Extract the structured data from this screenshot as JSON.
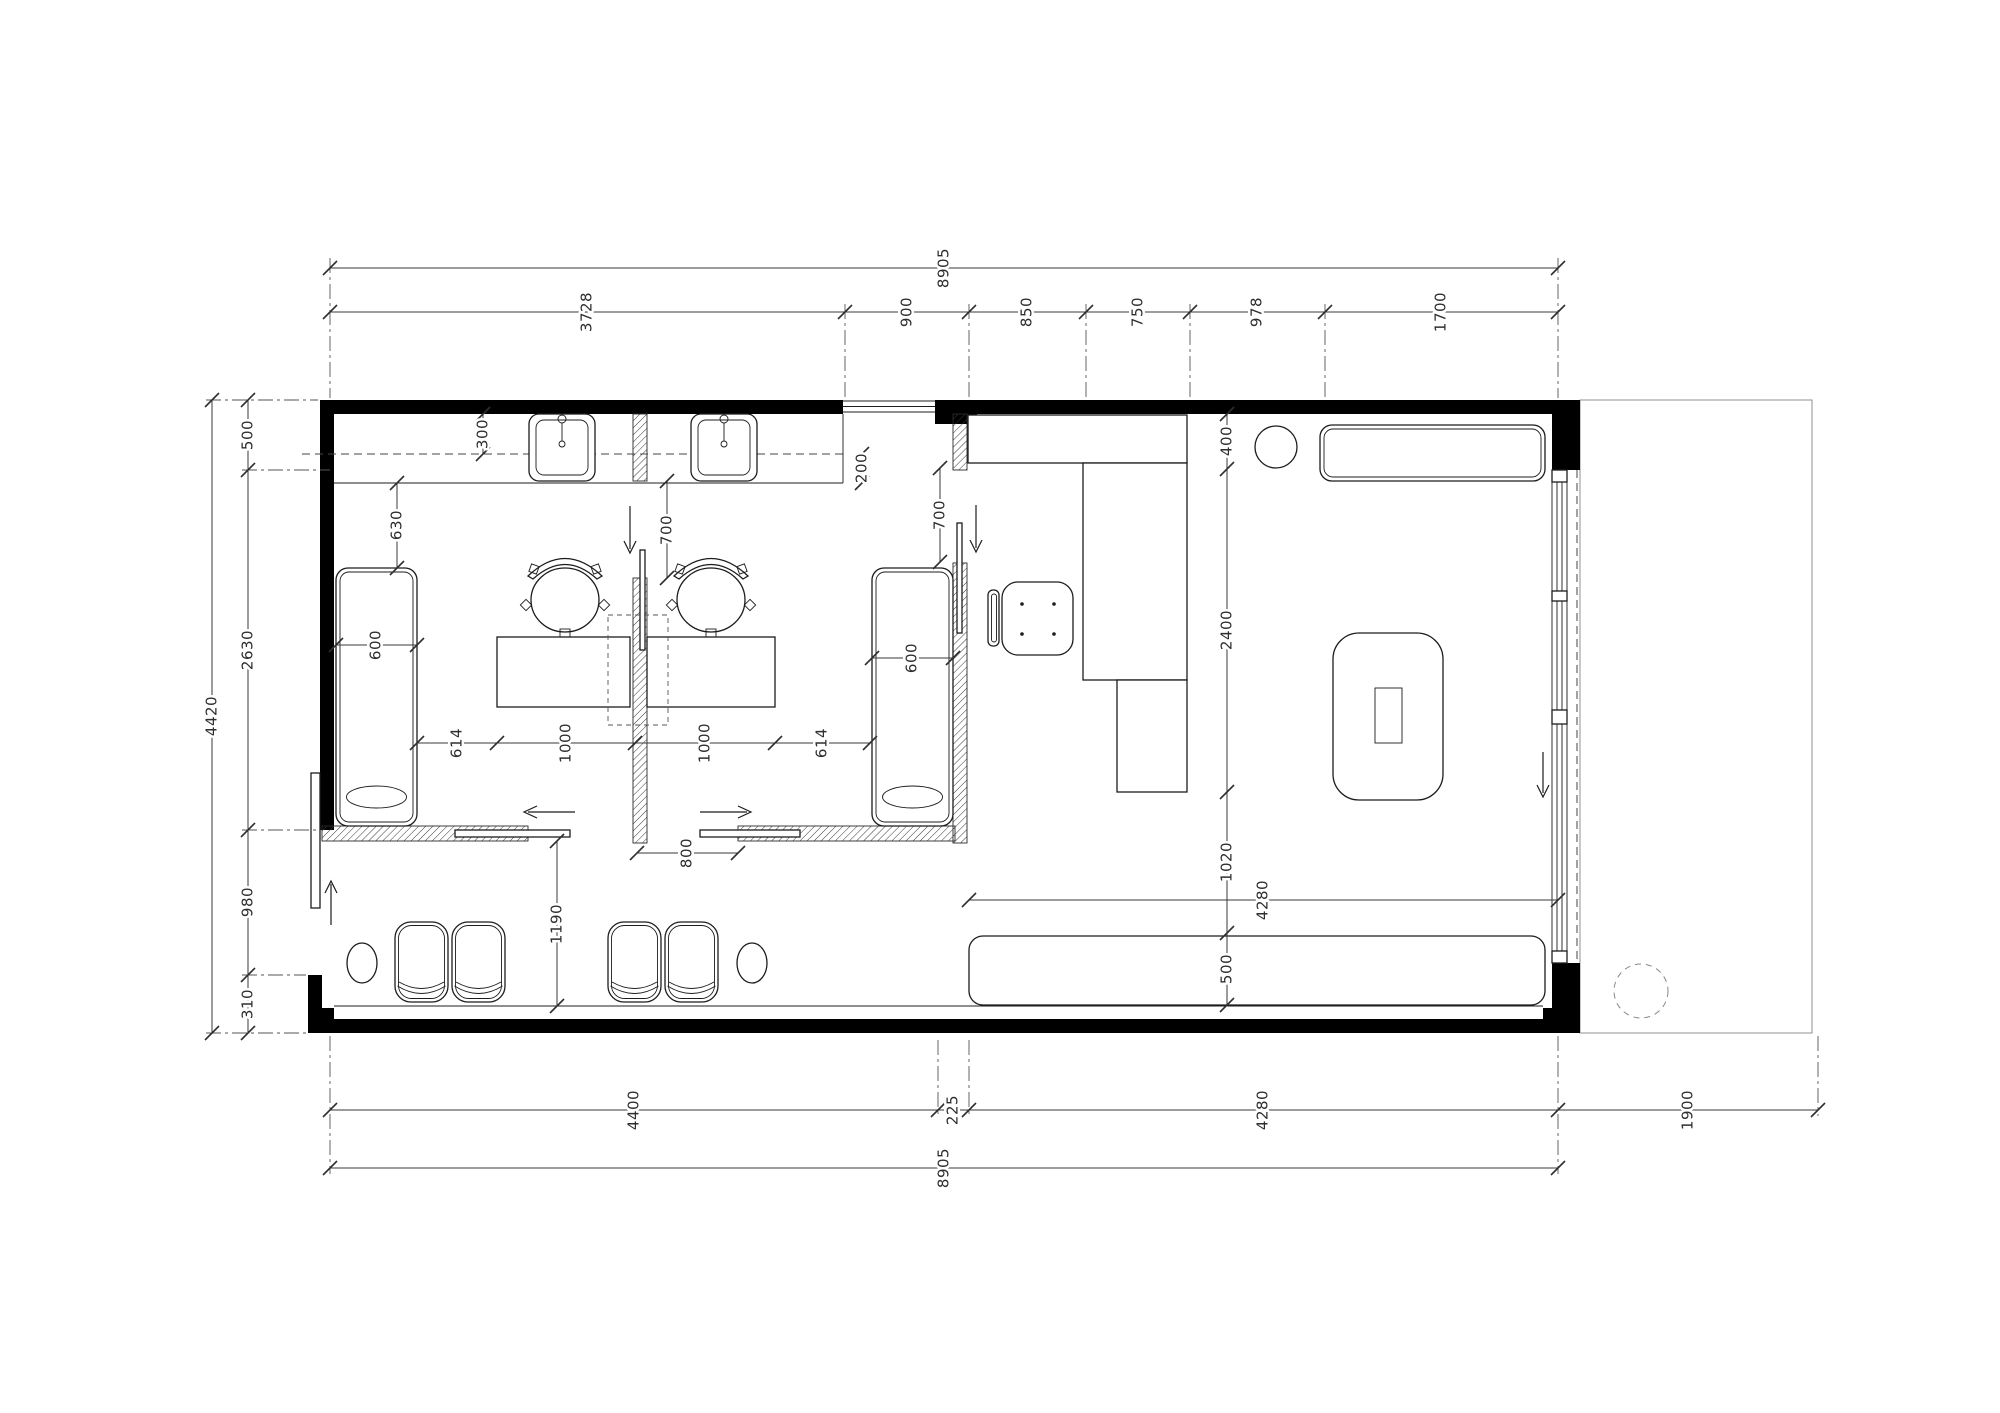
{
  "drawing": {
    "kind": "architectural-floor-plan",
    "units": "mm"
  },
  "colors": {
    "wall": "#000000",
    "line": "#1c1c1c",
    "dimension": "#2e2e2e",
    "terrace_outline": "#9a9a9a",
    "background": "#ffffff"
  },
  "dims": {
    "top_overall": "8905",
    "top_chain": [
      "3728",
      "900",
      "850",
      "750",
      "978",
      "1700"
    ],
    "left_overall": "4420",
    "left_chain": [
      "500",
      "2630",
      "980",
      "310"
    ],
    "right_chain": [
      "400",
      "2400",
      "1020",
      "500"
    ],
    "bottom_chain": [
      "4400",
      "225",
      "4280",
      "1900"
    ],
    "bottom_overall": "8905",
    "room1": {
      "counter_depth": "300",
      "bed_clearance": "630",
      "bed_width": "600",
      "door": "700"
    },
    "room2": {
      "counter_return": "200",
      "bed_width": "600",
      "door": "700"
    },
    "desk_row": [
      "614",
      "1000",
      "1000",
      "614"
    ],
    "corridor": {
      "door": "800",
      "width": "1190"
    },
    "lounge": {
      "bench_length": "4280"
    }
  }
}
